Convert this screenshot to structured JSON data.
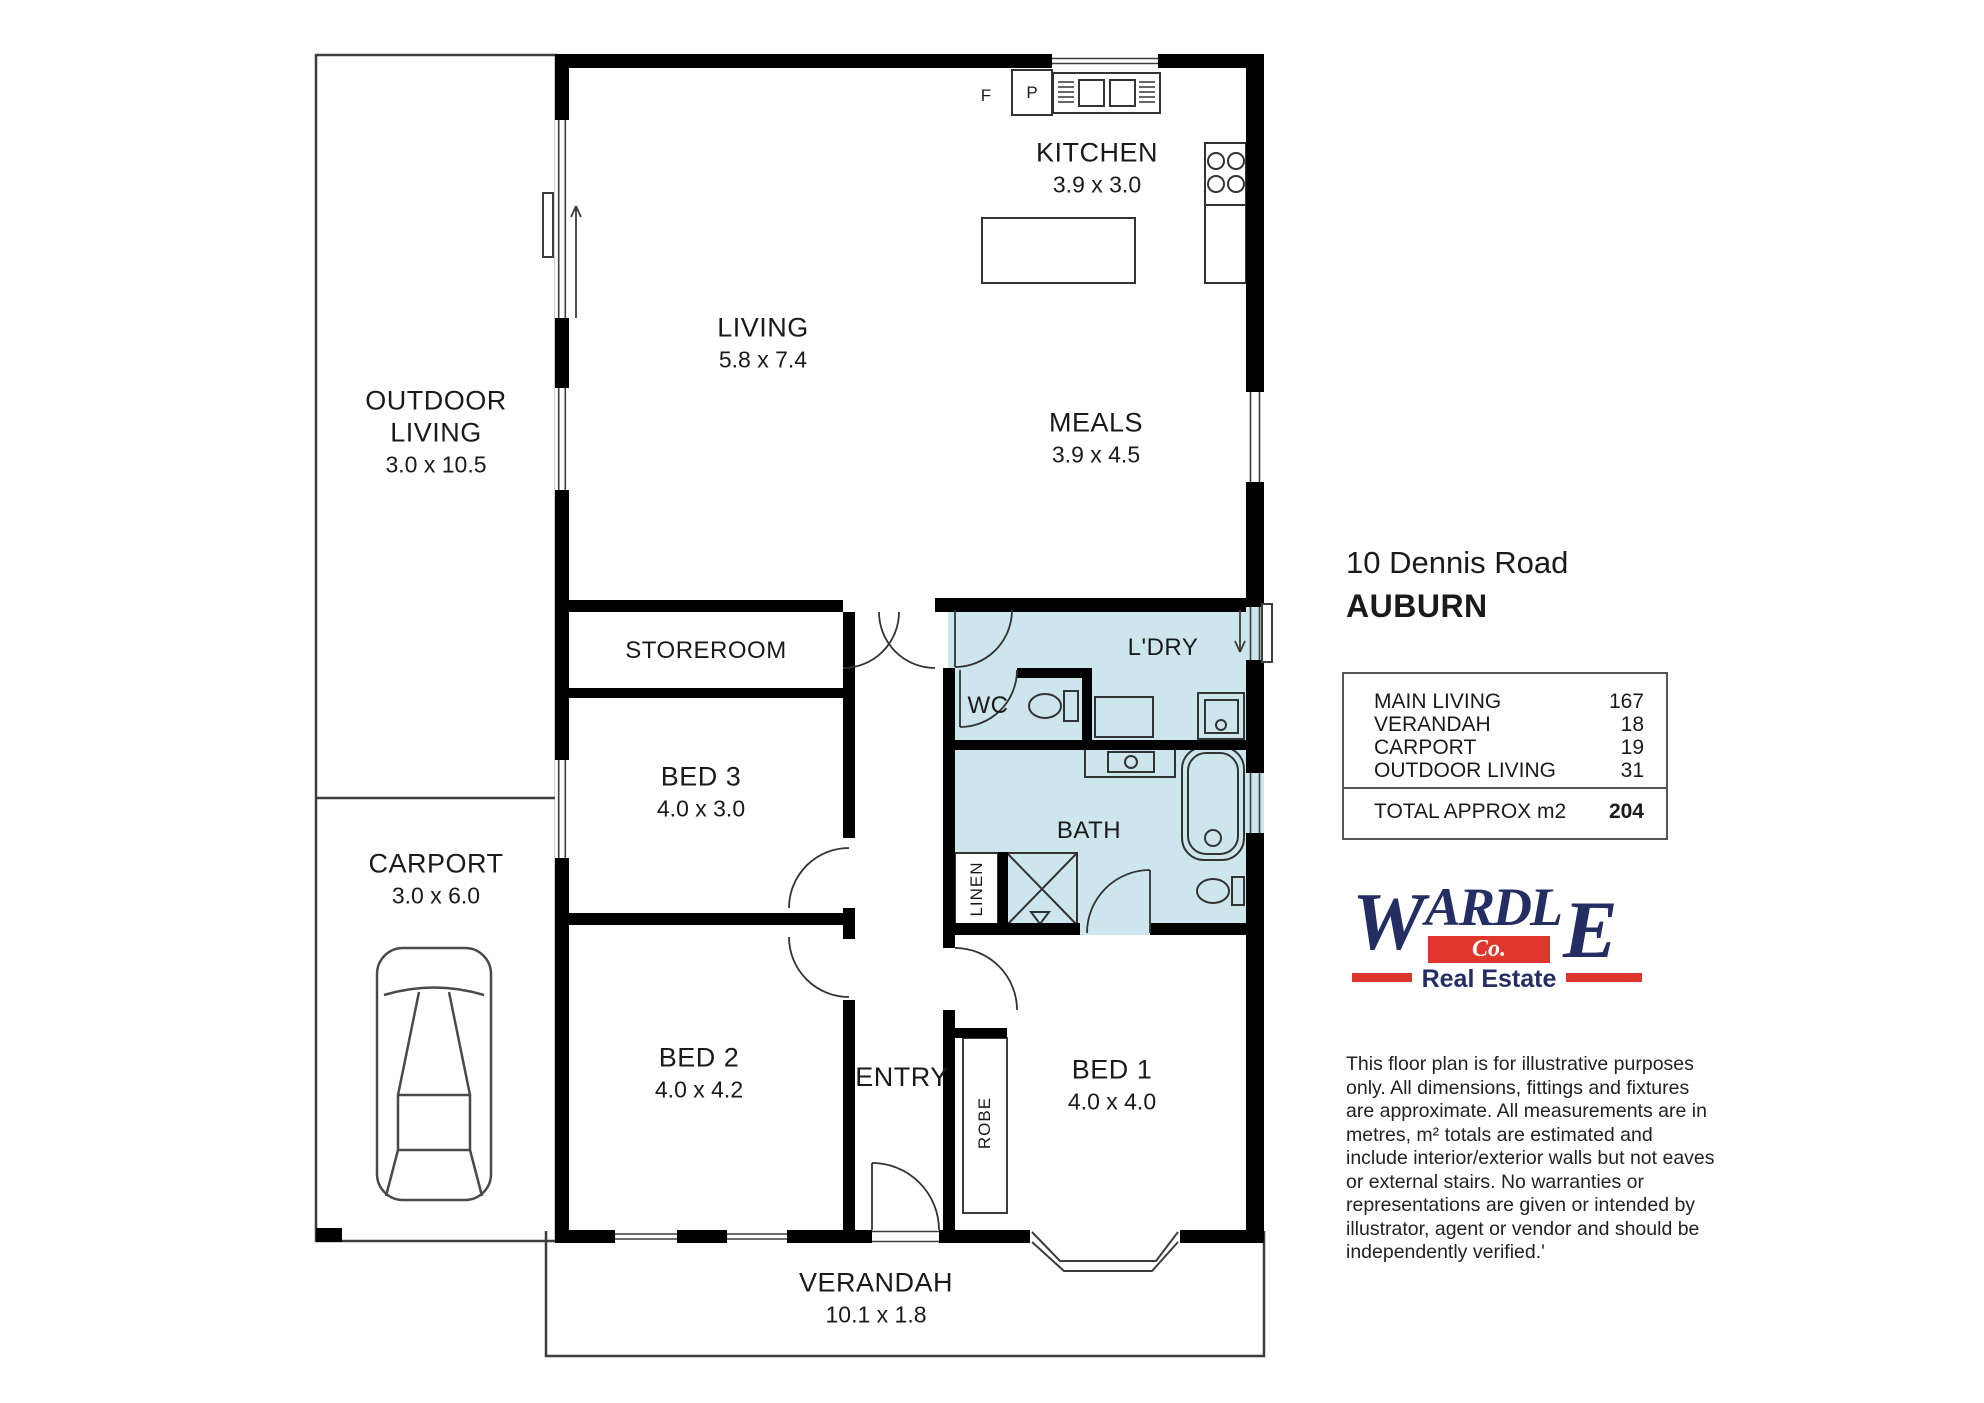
{
  "plan": {
    "rooms": {
      "kitchen": {
        "label": "KITCHEN",
        "dims": "3.9 x 3.0"
      },
      "living": {
        "label": "LIVING",
        "dims": "5.8 x 7.4"
      },
      "meals": {
        "label": "MEALS",
        "dims": "3.9 x 4.5"
      },
      "outdoor_living": {
        "label": "OUTDOOR\nLIVING",
        "dims": "3.0 x 10.5"
      },
      "storeroom": {
        "label": "STOREROOM"
      },
      "bed3": {
        "label": "BED 3",
        "dims": "4.0 x 3.0"
      },
      "carport": {
        "label": "CARPORT",
        "dims": "3.0 x 6.0"
      },
      "bed2": {
        "label": "BED 2",
        "dims": "4.0 x 4.2"
      },
      "entry": {
        "label": "ENTRY"
      },
      "bed1": {
        "label": "BED 1",
        "dims": "4.0 x 4.0"
      },
      "wc": {
        "label": "WC"
      },
      "ldry": {
        "label": "L'DRY"
      },
      "bath": {
        "label": "BATH"
      },
      "linen": {
        "label": "LINEN"
      },
      "robe": {
        "label": "ROBE"
      },
      "verandah": {
        "label": "VERANDAH",
        "dims": "10.1 x 1.8"
      }
    },
    "markers": {
      "fridge": "F",
      "pantry": "P"
    }
  },
  "info": {
    "address_line1": "10 Dennis Road",
    "address_line2": "AUBURN",
    "area_table": {
      "rows": [
        {
          "label": "MAIN LIVING",
          "value": "167"
        },
        {
          "label": "VERANDAH",
          "value": "18"
        },
        {
          "label": "CARPORT",
          "value": "19"
        },
        {
          "label": "OUTDOOR LIVING",
          "value": "31"
        }
      ],
      "total_label": "TOTAL APPROX m2",
      "total_value": "204"
    },
    "logo": {
      "name_w": "W",
      "name_mid": "ARDL",
      "name_e": "E",
      "co": "Co.",
      "tagline": "Real Estate"
    },
    "disclaimer": "This floor plan is for illustrative purposes only. All dimensions, fittings and fixtures are approximate. All measurements are in metres, m² totals are estimated and include interior/exterior walls but not eaves or external stairs. No warranties or representations are given or intended by illustrator, agent or vendor and should be independently verified.'"
  },
  "colors": {
    "wet_area": "#cde6ee",
    "wall": "#000000",
    "logo_navy": "#242e62",
    "logo_red": "#df372d"
  }
}
